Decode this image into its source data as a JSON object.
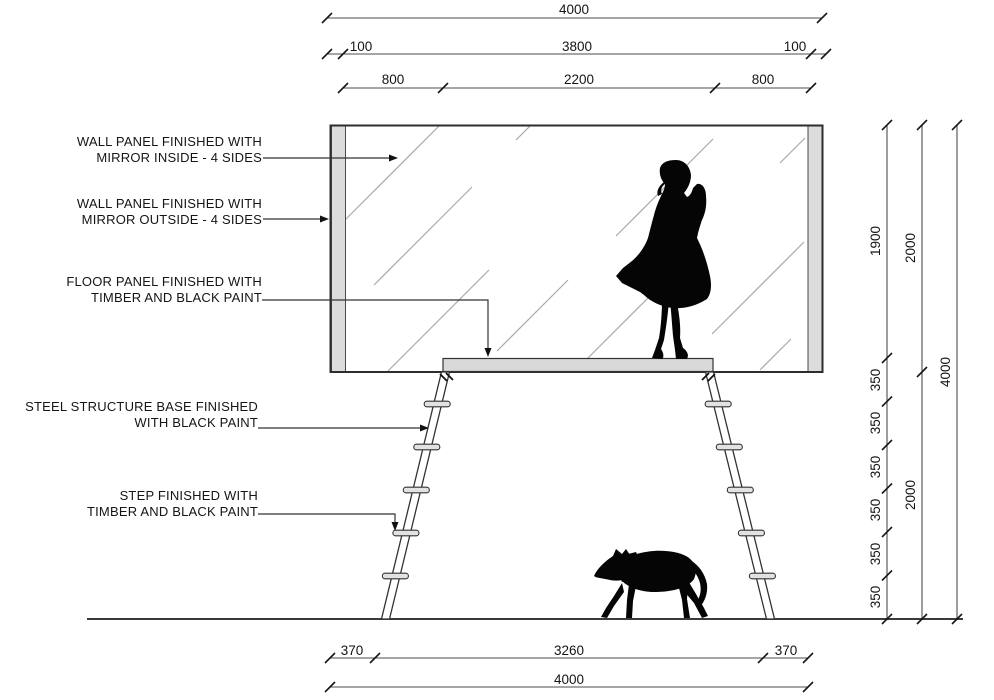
{
  "drawing_type": "architectural elevation",
  "colors": {
    "background": "#ffffff",
    "line": "#2d2d2d",
    "dimension_line": "#4d4d4d",
    "panel_fill": "#dcdcdc",
    "floor_fill": "#d9d9d9",
    "hatch": "#a9a9a9",
    "silhouette": "#050505"
  },
  "icons": {
    "woman": "woman-silhouette",
    "dog": "dog-silhouette"
  },
  "annotations": [
    {
      "line1": "WALL PANEL FINISHED WITH",
      "line2": "MIRROR INSIDE - 4 SIDES"
    },
    {
      "line1": "WALL PANEL FINISHED WITH",
      "line2": "MIRROR OUTSIDE - 4 SIDES"
    },
    {
      "line1": "FLOOR PANEL FINISHED WITH",
      "line2": "TIMBER AND BLACK PAINT"
    },
    {
      "line1": "STEEL STRUCTURE BASE FINISHED",
      "line2": "WITH BLACK PAINT"
    },
    {
      "line1": "STEP FINISHED WITH",
      "line2": "TIMBER AND BLACK PAINT"
    }
  ],
  "dimensions": {
    "top_row1": [
      "4000"
    ],
    "top_row2": [
      "100",
      "3800",
      "100"
    ],
    "top_row3": [
      "800",
      "2200",
      "800"
    ],
    "right_inner": [
      "1900",
      "350",
      "350",
      "350",
      "350",
      "350",
      "350"
    ],
    "right_middle": [
      "2000",
      "2000"
    ],
    "right_outer": [
      "4000"
    ],
    "bottom_row1": [
      "370",
      "3260",
      "370"
    ],
    "bottom_row2": [
      "4000"
    ]
  }
}
